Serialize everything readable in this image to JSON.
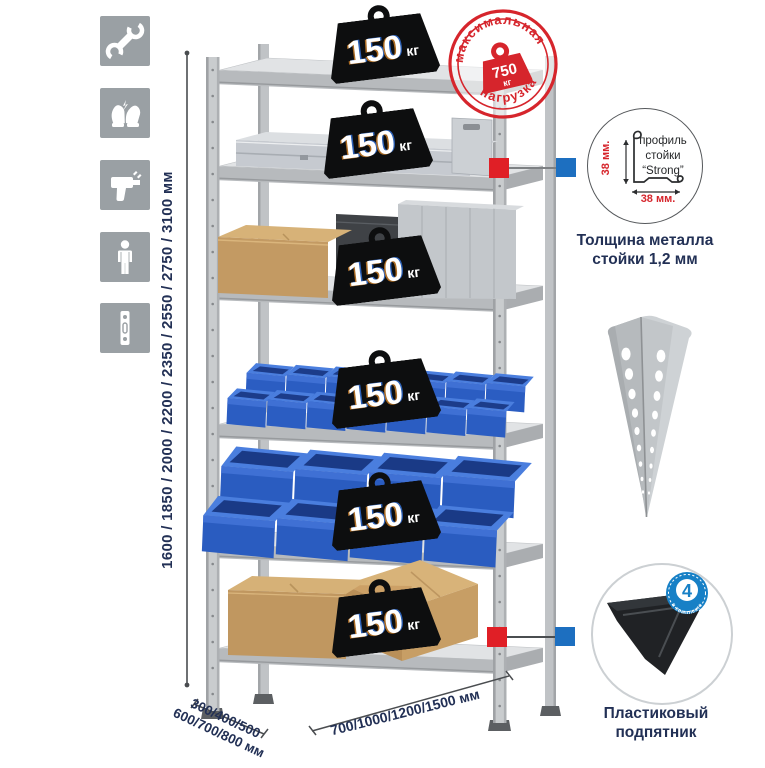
{
  "page": {
    "background": "#ffffff"
  },
  "left_icons": [
    {
      "name": "wrench-icon"
    },
    {
      "name": "gloves-icon"
    },
    {
      "name": "drill-icon"
    },
    {
      "name": "person-icon"
    },
    {
      "name": "perforated-post-icon"
    }
  ],
  "height_dimension": {
    "label": "1600 / 1850 / 2000 / 2200 / 2350 / 2550 / 2750 / 3100 мм"
  },
  "rack": {
    "shelf_count": 6,
    "badges": [
      {
        "value": "150",
        "unit": "кг"
      },
      {
        "value": "150",
        "unit": "кг"
      },
      {
        "value": "150",
        "unit": "кг"
      },
      {
        "value": "150",
        "unit": "кг"
      },
      {
        "value": "150",
        "unit": "кг"
      },
      {
        "value": "150",
        "unit": "кг"
      }
    ]
  },
  "max_load_stamp": {
    "top_text": "максимальная",
    "bottom_text": "нагрузка",
    "value": "750",
    "unit": "кг"
  },
  "profile_detail": {
    "label_line1": "профиль",
    "label_line2": "стойки",
    "label_line3": "“Strong”",
    "height_label": "38 мм.",
    "width_label": "38 мм."
  },
  "thickness_caption": {
    "line1": "Толщина металла",
    "line2": "стойки 1,2 мм"
  },
  "foot_detail": {
    "badge_value": "4",
    "badge_ring_text": "в комплекте",
    "caption_line1": "Пластиковый",
    "caption_line2": "подпятник"
  },
  "depth_dimension": {
    "line1": "300/400/500",
    "line2": "600/700/800 мм"
  },
  "width_dimension": {
    "label": "700/1000/1200/1500 мм"
  },
  "colors": {
    "stamp_red": "#d6252c",
    "marker_red": "#e01f26",
    "marker_blue": "#1d6fc0",
    "text_navy": "#223055",
    "bin_blue": "#2a5cc0",
    "count_badge_blue": "#1780c6",
    "icon_gray": "#9aa0a4"
  }
}
